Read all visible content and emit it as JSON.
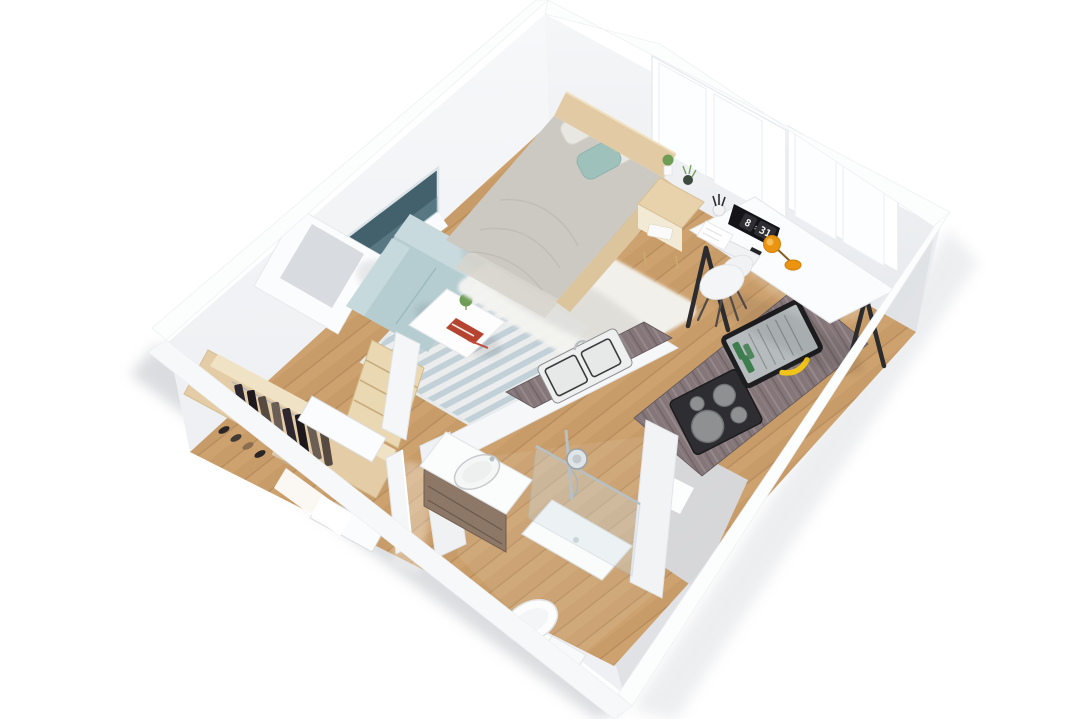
{
  "scene": {
    "type": "isometric-3d-floor-plan",
    "subject": "studio apartment 3D render",
    "background": "#ffffff"
  },
  "monitor_clock": {
    "hours": "8",
    "separator": ":",
    "minutes": "31"
  },
  "colors": {
    "wall_cap": "#fcfdfd",
    "face_bright": "#f4f5f7",
    "face_shadow": "#dcdfe3",
    "floor_wood": "#cda26f",
    "floor_wood_dark": "#bf935e",
    "floor_groove": "#a87e52",
    "rug_white": "#f4f4f1",
    "rug_stripe_a": "#c2d4dd",
    "rug_stripe_b": "#edf2f5",
    "sofa": "#b5cdd1",
    "sofa_light": "#c8dadd",
    "bed_duvet": "#cbc9c1",
    "bed_sheet": "#d7d5cd",
    "pillow_light": "#e9e7e2",
    "pillow_teal": "#9ec1bc",
    "headboard": "#e2cba4",
    "frame_wood": "#dcc49c",
    "nightstand": "#e8d2ac",
    "desk_top": "#fbfcfd",
    "desk_leg": "#2c2c2e",
    "monitor": "#141418",
    "clock_card": "#2f2f33",
    "clock_text": "#f4f4f4",
    "chair": "#f4f5f6",
    "chair_leg": "#504b48",
    "lamp_orange": "#eb9410",
    "counter_marble": "#857779",
    "marble_light": "#a3969a",
    "marble_dark": "#675c60",
    "sink_steel": "#eef0f0",
    "sink_rim": "#3c3c3e",
    "cooktop": "#2e2e32",
    "burner": "#8e9092",
    "dishrack_frame": "#1e1e20",
    "dishrack_body": "#b6bcbe",
    "bottle_green": "#3e7d4d",
    "banana_yellow": "#f0c419",
    "vanity_top": "#fbfcfc",
    "vanity_cabinet": "#8d7868",
    "shower_glass": "#cfe0e8",
    "chrome": "#b7c0c4",
    "toilet_white": "#fdfdfd",
    "wardrobe_wood": "#e4cda6",
    "wardrobe_shelf": "#f0e2c4",
    "clothes_a": "#2e2730",
    "clothes_b": "#1d181c",
    "clothes_c": "#564a41",
    "clothes_d": "#6b5e54",
    "window_glass": "#42616d",
    "plant_green": "#6f9d56",
    "pot_dark": "#3c4a40",
    "book_red": "#b5432f",
    "door_white": "#fbfcfd"
  },
  "objects": [
    "bed",
    "headboard",
    "pillows",
    "teal-accent-pillow",
    "white-fluffy-rug",
    "nightstand",
    "potted-plants",
    "sofa",
    "striped-rug",
    "coffee-table",
    "books",
    "left-wall-window",
    "duct-column",
    "desk",
    "monitor-flip-clock",
    "keyboard",
    "paper-sheet",
    "pen-cup",
    "desk-lamp",
    "desk-chair",
    "kitchen-sink-counter",
    "double-sink",
    "wall-counter",
    "cooktop",
    "dish-rack",
    "bottles",
    "banana",
    "wardrobe",
    "hanging-clothes",
    "shoes",
    "shelf-unit",
    "hallway-doors",
    "bathroom-vanity",
    "vanity-sink",
    "shower",
    "shower-head",
    "toilet",
    "windows"
  ]
}
